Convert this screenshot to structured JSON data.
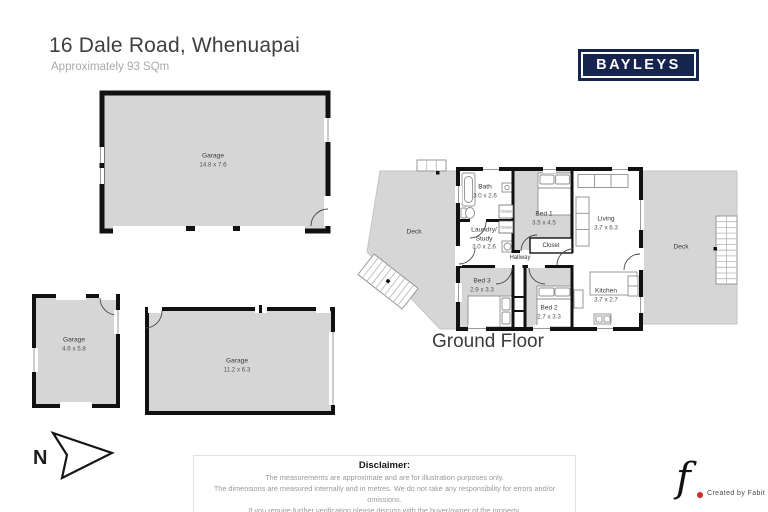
{
  "header": {
    "title": "16 Dale Road, Whenuapai",
    "subtitle": "Approximately 93 SQm"
  },
  "brand": {
    "logo_text": "BAYLEYS"
  },
  "colors": {
    "brand_navy": "#15254d",
    "plan_gray": "#d6d6d6",
    "wall_black": "#111111",
    "credit_red": "#cf2b26"
  },
  "buildings": {
    "garage_large": {
      "name": "Garage",
      "dims": "14.8 x 7.6"
    },
    "garage_small": {
      "name": "Garage",
      "dims": "4.6 x 5.8"
    },
    "garage_long": {
      "name": "Garage",
      "dims": "11.2 x 6.3"
    }
  },
  "floorplan": {
    "floor_label": "Ground Floor",
    "deck_left": {
      "name": "Deck"
    },
    "deck_right": {
      "name": "Deck"
    },
    "bath": {
      "name": "Bath",
      "dims": "3.0 x 2.6"
    },
    "bed1": {
      "name": "Bed 1",
      "dims": "3.5 x 4.5"
    },
    "living": {
      "name": "Living",
      "dims": "3.7 x 6.3"
    },
    "laundry": {
      "name": "Laundry/ Study",
      "dims": "3.0 x 2.6"
    },
    "closet": {
      "name": "Closet"
    },
    "closet_small_1": {
      "name": "Closet"
    },
    "closet_small_2": {
      "name": "Closet"
    },
    "hallway": {
      "name": "Hallway"
    },
    "bed3": {
      "name": "Bed 3",
      "dims": "2.9 x 3.3"
    },
    "bed2": {
      "name": "Bed 2",
      "dims": "2.7 x 3.3"
    },
    "kitchen": {
      "name": "Kitchen",
      "dims": "3.7 x 2.7"
    }
  },
  "compass": {
    "label": "N"
  },
  "disclaimer": {
    "title": "Disclaimer:",
    "lines": [
      "The measurements are approximate and are for illustration purposes only.",
      "The dimensions are measured internally and in metres. We do not take any responsibility for errors and/or omissions.",
      "If you require further verification please discuss with the buyer/owner of the property."
    ]
  },
  "credit": {
    "glyph": "f",
    "text": "Created by Fabit"
  }
}
